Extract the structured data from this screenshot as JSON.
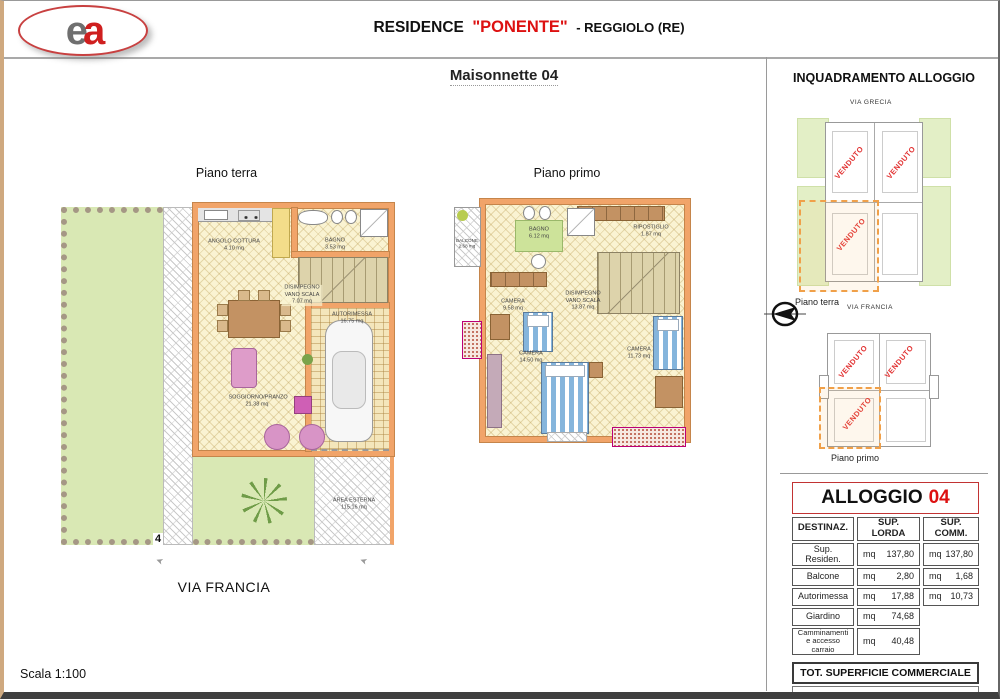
{
  "header": {
    "logo_e": "e",
    "logo_a": "a",
    "title_residence": "RESIDENCE",
    "title_name": "\"PONENTE\"",
    "title_location": "- REGGIOLO (RE)"
  },
  "subtitle": "Maisonnette 04",
  "plans": {
    "terra": {
      "label": "Piano terra",
      "street": "VIA FRANCIA",
      "lot_number": "4",
      "rooms": {
        "cottura": {
          "name": "ANGOLO COTTURA",
          "area": "4.10 mq"
        },
        "bagno": {
          "name": "BAGNO",
          "area": "3.53 mq"
        },
        "disimpegno": {
          "name": "DISIMPEGNO VANO SCALA",
          "area": "7.07 mq"
        },
        "autorimessa": {
          "name": "AUTORIMESSA",
          "area": "16.75 mq"
        },
        "soggiorno": {
          "name": "SOGGIORNO/PRANZO",
          "area": "21.38 mq"
        },
        "area_esterna": {
          "name": "AREA ESTERNA",
          "area": "115.16 mq"
        }
      }
    },
    "primo": {
      "label": "Piano primo",
      "rooms": {
        "balcone": {
          "name": "BALCONE",
          "area": "2.68 mq"
        },
        "bagno": {
          "name": "BAGNO",
          "area": "6.12 mq"
        },
        "ripostiglio": {
          "name": "RIPOSTIGLIO",
          "area": "1.87 mq"
        },
        "disimpegno": {
          "name": "DISIMPEGNO VANO SCALA",
          "area": "13.87 mq"
        },
        "camera1": {
          "name": "CAMERA",
          "area": "9.58 mq"
        },
        "camera2": {
          "name": "CAMERA",
          "area": "14.50 mq"
        },
        "camera3": {
          "name": "CAMERA",
          "area": "11.73 mq"
        }
      }
    }
  },
  "inquadramento": {
    "title": "INQUADRAMENTO ALLOGGIO",
    "via_top": "VIA GRECIA",
    "via_bottom": "VIA FRANCIA",
    "plan1_label": "Piano terra",
    "plan2_label": "Piano primo",
    "venduto": "VENDUTO"
  },
  "table": {
    "title": "ALLOGGIO",
    "unit_number": "04",
    "headers": [
      "DESTINAZ.",
      "SUP. LORDA",
      "SUP. COMM."
    ],
    "rows": [
      {
        "dest": "Sup. Residen.",
        "lorda_unit": "mq",
        "lorda": "137,80",
        "comm_unit": "mq",
        "comm": "137,80"
      },
      {
        "dest": "Balcone",
        "lorda_unit": "mq",
        "lorda": "2,80",
        "comm_unit": "mq",
        "comm": "1,68"
      },
      {
        "dest": "Autorimessa",
        "lorda_unit": "mq",
        "lorda": "17,88",
        "comm_unit": "mq",
        "comm": "10,73"
      },
      {
        "dest": "Giardino",
        "lorda_unit": "mq",
        "lorda": "74,68",
        "comm_unit": "",
        "comm": ""
      },
      {
        "dest": "Camminamenti e accesso carraio",
        "lorda_unit": "mq",
        "lorda": "40,48",
        "comm_unit": "",
        "comm": ""
      }
    ],
    "total_label": "TOT. SUPERFICIE COMMERCIALE",
    "total_value": "150,21",
    "total_unit": "mq"
  },
  "footer": {
    "scale": "Scala 1:100"
  }
}
